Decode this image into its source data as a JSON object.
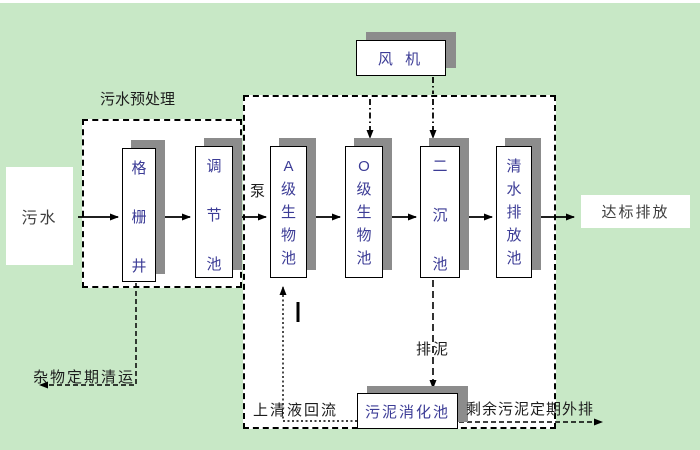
{
  "diagram": {
    "source": {
      "label": "污水"
    },
    "pretreatment": {
      "title": "污水预处理",
      "grid_well": "格栅井",
      "regulating_tank": "调节池"
    },
    "pump": "泵",
    "blower": "风 机",
    "biological": {
      "tank_a": "A级生物池",
      "tank_o": "O级生物池",
      "secondary_clarifier": "二沉池",
      "clear_water_tank": "清水排放池",
      "supernatant_return": "上清液回流",
      "sludge_discharge": "排泥",
      "sludge_digester": "污泥消化池"
    },
    "outputs": {
      "discharge": "达标排放",
      "debris_removal": "杂物定期清运",
      "excess_sludge": "剩余污泥定期外排"
    }
  },
  "colors": {
    "background": "#c8e8c6",
    "box_fill": "#ffffff",
    "border": "#000000",
    "shadow": "#8c8c8c",
    "tank_text": "#3c3c96",
    "label_text": "#1c1c1c"
  }
}
